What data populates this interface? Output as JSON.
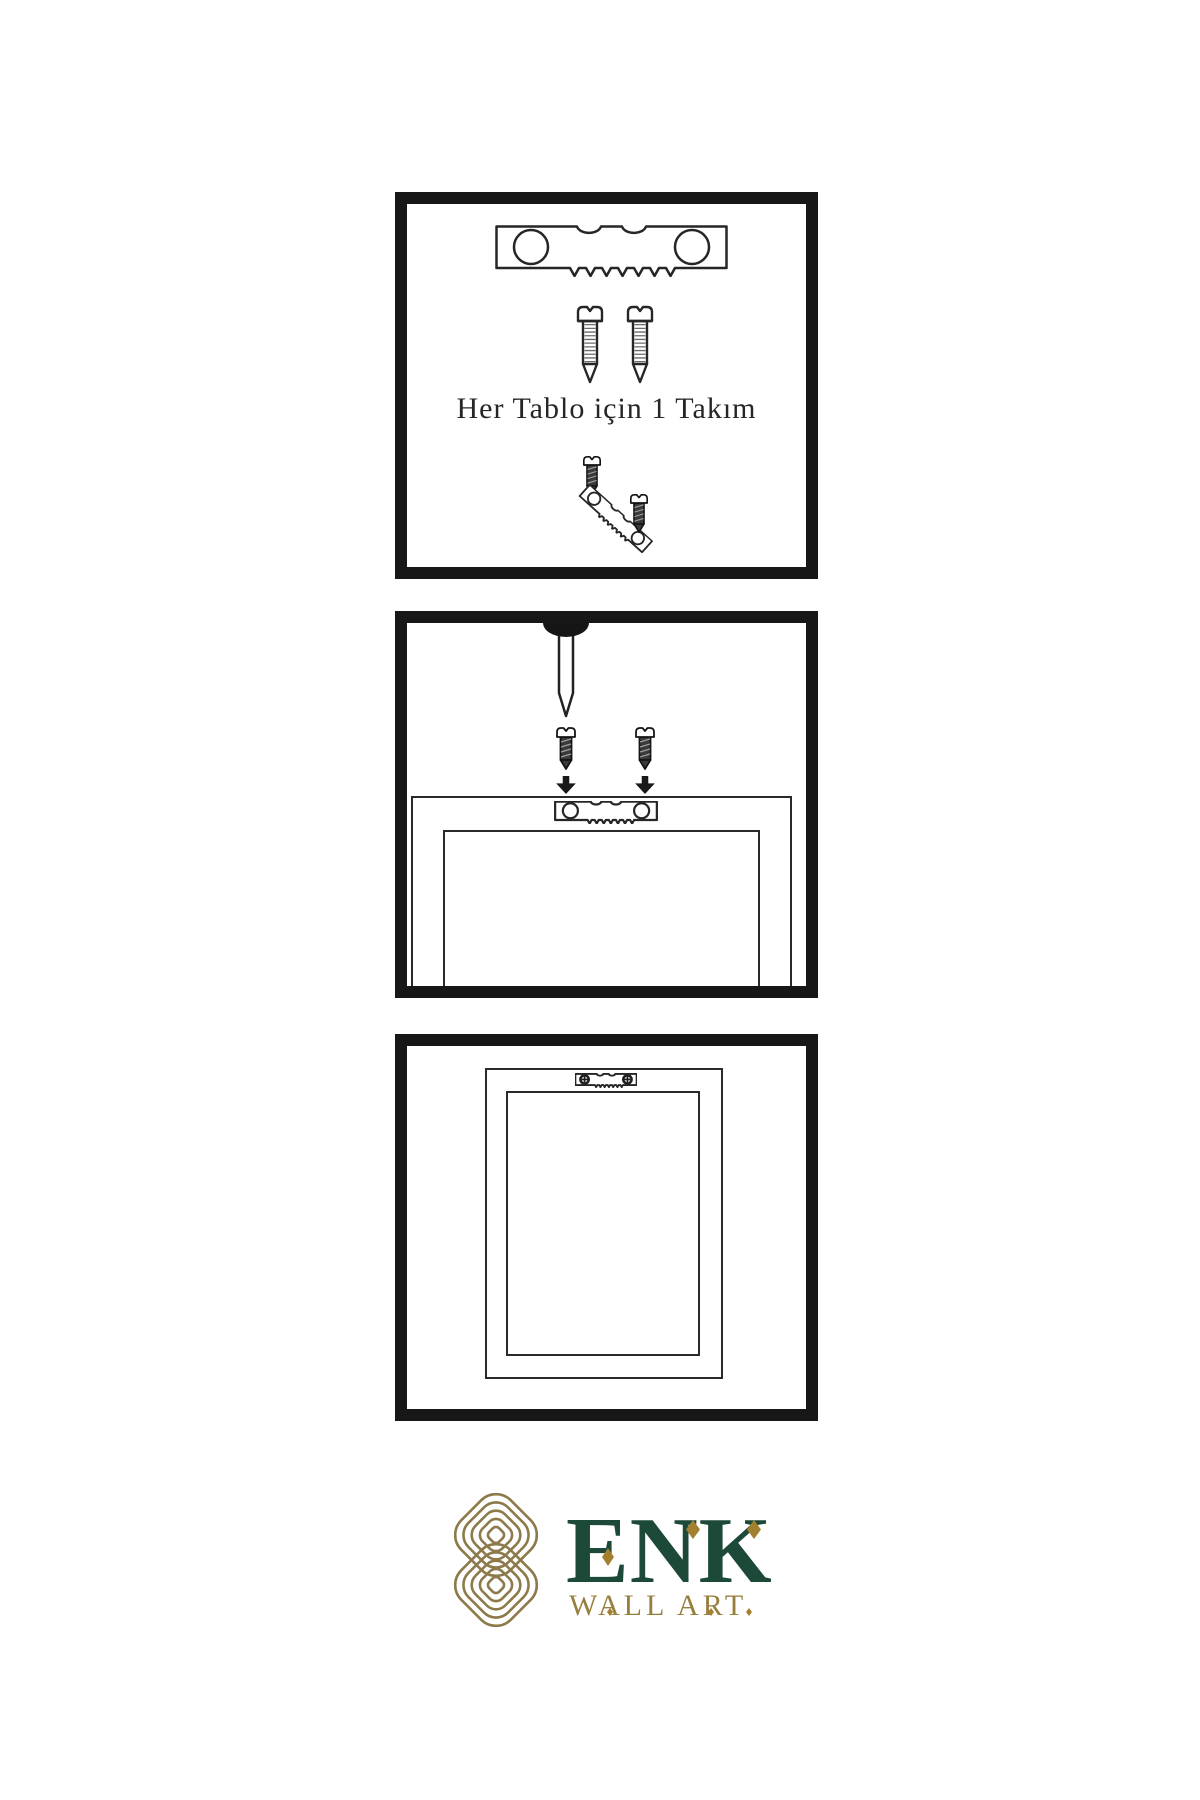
{
  "page": {
    "background": "#ffffff"
  },
  "panels": [
    {
      "id": "hardware-set",
      "caption": "Her Tablo için 1 Takım"
    },
    {
      "id": "nail-and-screws",
      "caption": ""
    },
    {
      "id": "hanging-frame",
      "caption": ""
    }
  ],
  "brand": {
    "name": "ENK",
    "tagline": "WALL ART",
    "colors": {
      "green": "#1d4a38",
      "gold": "#97803f",
      "knot": "#8d7a4b",
      "accent": "#a3802f",
      "ink": "#171717",
      "line": "#2a2a2a"
    }
  },
  "icons": [
    "sawtooth-hanger-icon",
    "screw-icon",
    "dark-screw-icon",
    "nail-icon",
    "arrow-down-icon",
    "phillips-screw-icon",
    "knot-logo-icon",
    "diamond-accent-icon"
  ]
}
